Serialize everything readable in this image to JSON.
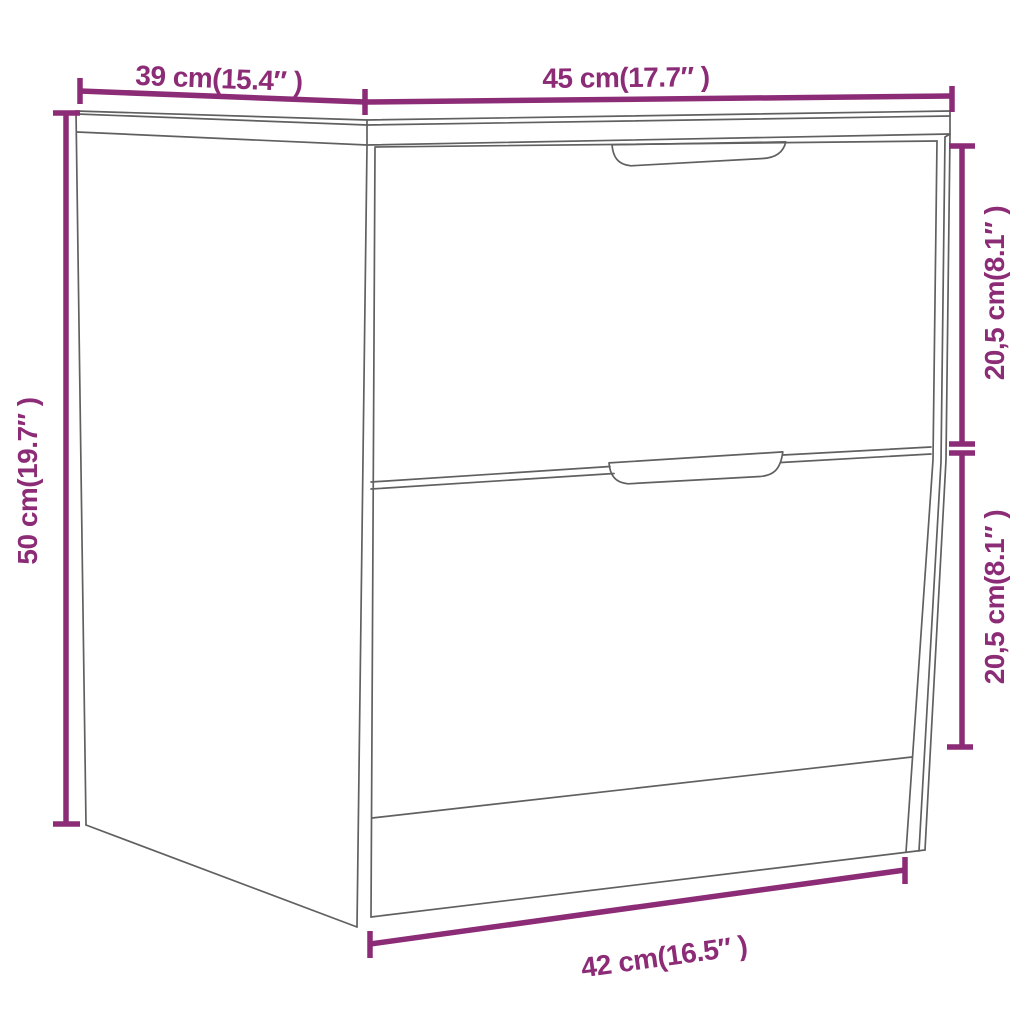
{
  "figure": {
    "kind": "product-dimension-diagram",
    "product": "nightstand with two drawers, line drawing in perspective"
  },
  "colors": {
    "dimension_accent": "#8C2B76",
    "line_art": "#606060",
    "background": "#FFFFFF"
  },
  "dimensions": {
    "depth_top": {
      "label": "39 cm(15.4″ )",
      "measures": "top depth (left)"
    },
    "width_top": {
      "label": "45 cm(17.7″ )",
      "measures": "top width (front)"
    },
    "height_left": {
      "label": "50 cm(19.7″ )",
      "measures": "overall height"
    },
    "drawer_top_right": {
      "label": "20,5 cm(8.1″ )",
      "measures": "top drawer height"
    },
    "drawer_bottom_right": {
      "label": "20,5 cm(8.1″ )",
      "measures": "bottom drawer height"
    },
    "base_width_bottom": {
      "label": "42 cm(16.5″ )",
      "measures": "base width"
    }
  }
}
